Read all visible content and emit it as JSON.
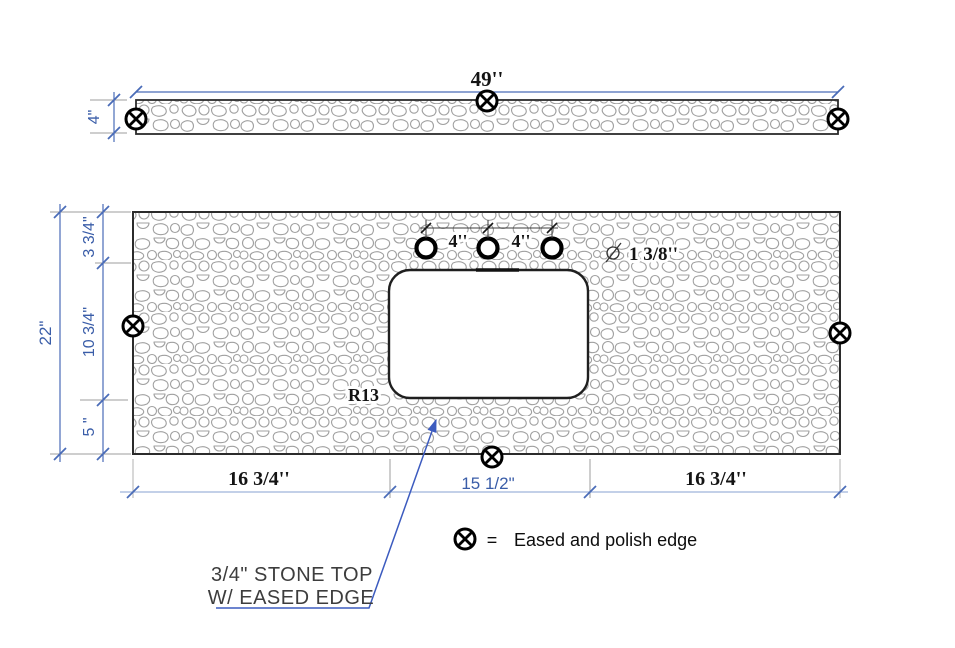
{
  "backsplash": {
    "width_label": "49''",
    "height_label": "4\""
  },
  "countertop": {
    "depth_label": "22\"",
    "left_segments": {
      "top": "3 3/4\"",
      "middle": "10 3/4\"",
      "bottom": "5 \""
    },
    "faucet": {
      "spacing_left_label": "4''",
      "spacing_right_label": "4''",
      "hole_diameter_label": "1 3/8''"
    },
    "sink": {
      "corner_radius_label": "R13"
    },
    "bottom_segments": {
      "left": "16 3/4''",
      "middle": "15 1/2\"",
      "right": "16 3/4''"
    }
  },
  "legend": {
    "equals": "=",
    "label": "Eased and polish edge"
  },
  "note": {
    "line1": "3/4\" STONE TOP",
    "line2": "W/ EASED EDGE"
  },
  "colors": {
    "dim_text_blue": "#3a5da8",
    "dim_line_blue": "#4a6cb8",
    "dim_line_light_blue": "#9fb3d9",
    "extension_gray": "#9c9c9c",
    "ink_black": "#141414",
    "note_gray": "#3d3d3d",
    "leader_blue": "#3c5bbf",
    "pattern_gray": "#a0a0a0"
  }
}
